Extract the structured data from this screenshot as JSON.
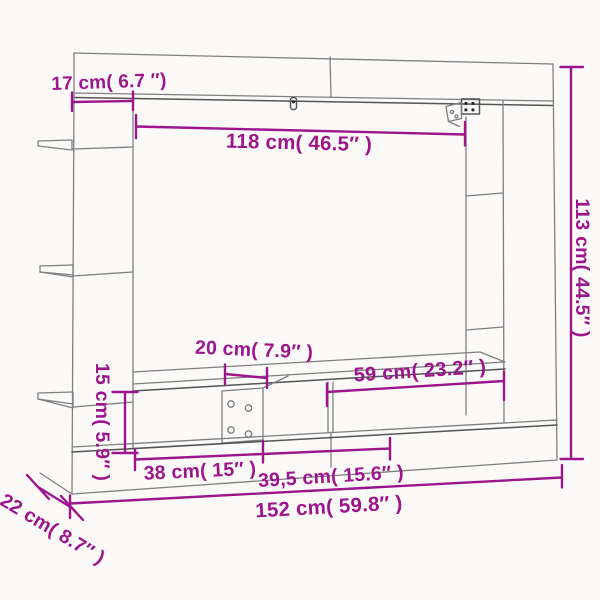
{
  "diagram": {
    "background_color": "#fbfaf8",
    "outline_color": "#7f7f7f",
    "dimension_color": "#9d158d",
    "dimensions": {
      "top_depth": {
        "label": "17 cm( 6.7 ″)"
      },
      "tv_opening_width": {
        "label": "118 cm( 46.5″ )"
      },
      "overall_height": {
        "label": "113 cm( 44.5″ )"
      },
      "center_bracket_width": {
        "label": "20 cm( 7.9″ )"
      },
      "right_opening_width": {
        "label": "59 cm( 23.2″ )"
      },
      "bench_opening_height": {
        "label": "15 cm( 5.9″ )"
      },
      "left_opening_width": {
        "label": "38 cm( 15″ )"
      },
      "middle_opening_width": {
        "label": "39,5 cm( 15.6″ )"
      },
      "overall_width": {
        "label": "152 cm( 59.8″ )"
      },
      "overall_depth": {
        "label": "22 cm( 8.7″ )"
      }
    }
  }
}
